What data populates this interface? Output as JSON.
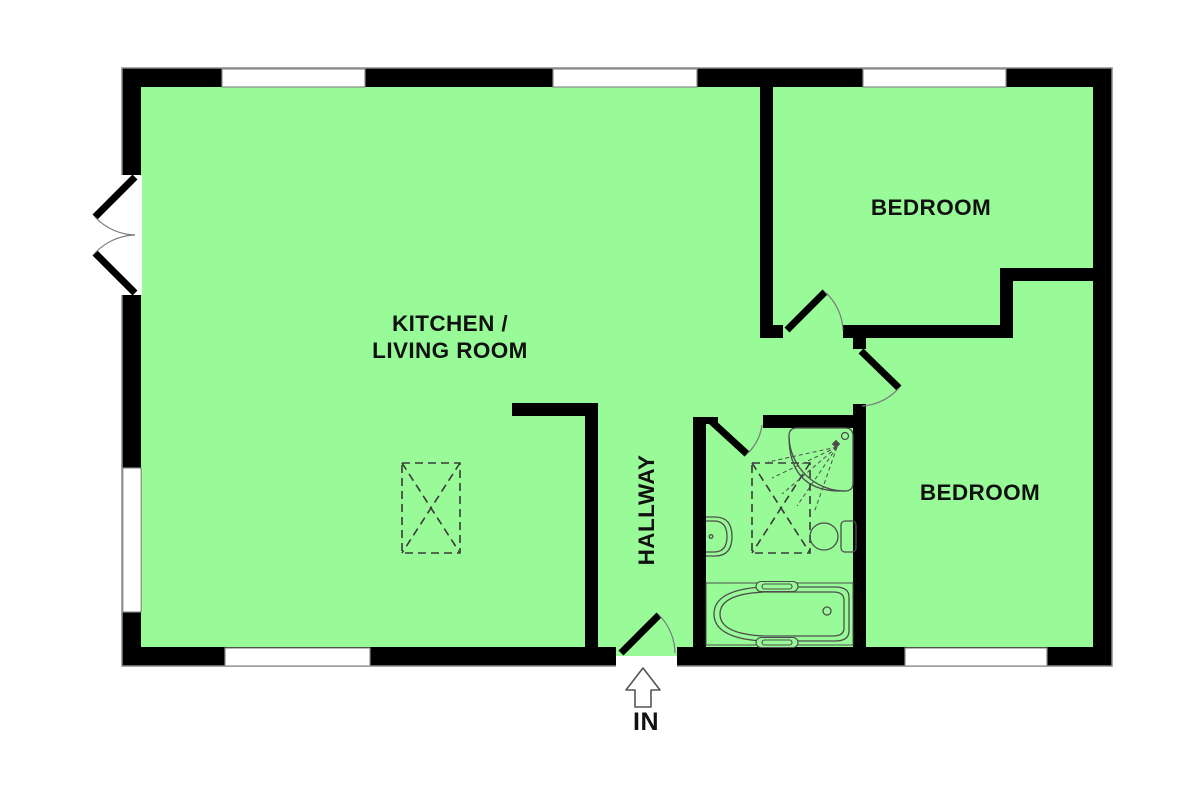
{
  "rooms": {
    "kitchen_living": {
      "label_line1": "KITCHEN /",
      "label_line2": "LIVING ROOM"
    },
    "bedroom_top": {
      "label": "BEDROOM"
    },
    "bedroom_bottom": {
      "label": "BEDROOM"
    },
    "hallway": {
      "label": "HALLWAY"
    },
    "bathroom": {
      "label": ""
    }
  },
  "entrance": {
    "label": "IN",
    "arrow_icon": "up-arrow-icon"
  },
  "fixtures": {
    "shower": "corner-shower-icon",
    "sink": "wash-basin-icon",
    "toilet": "toilet-icon",
    "bath": "bath-tub-icon",
    "rooflight_kitchen": "rooflight-dashed-icon",
    "rooflight_bathroom": "rooflight-dashed-icon"
  },
  "colors": {
    "floor": "#98FB98",
    "wall": "#000000",
    "window": "#FFFFFF",
    "outline": "#8A8A8A",
    "fixture": "#4D4D4D",
    "arc": "#7A7A7A",
    "text": "#111111",
    "background": "#FFFFFF"
  }
}
